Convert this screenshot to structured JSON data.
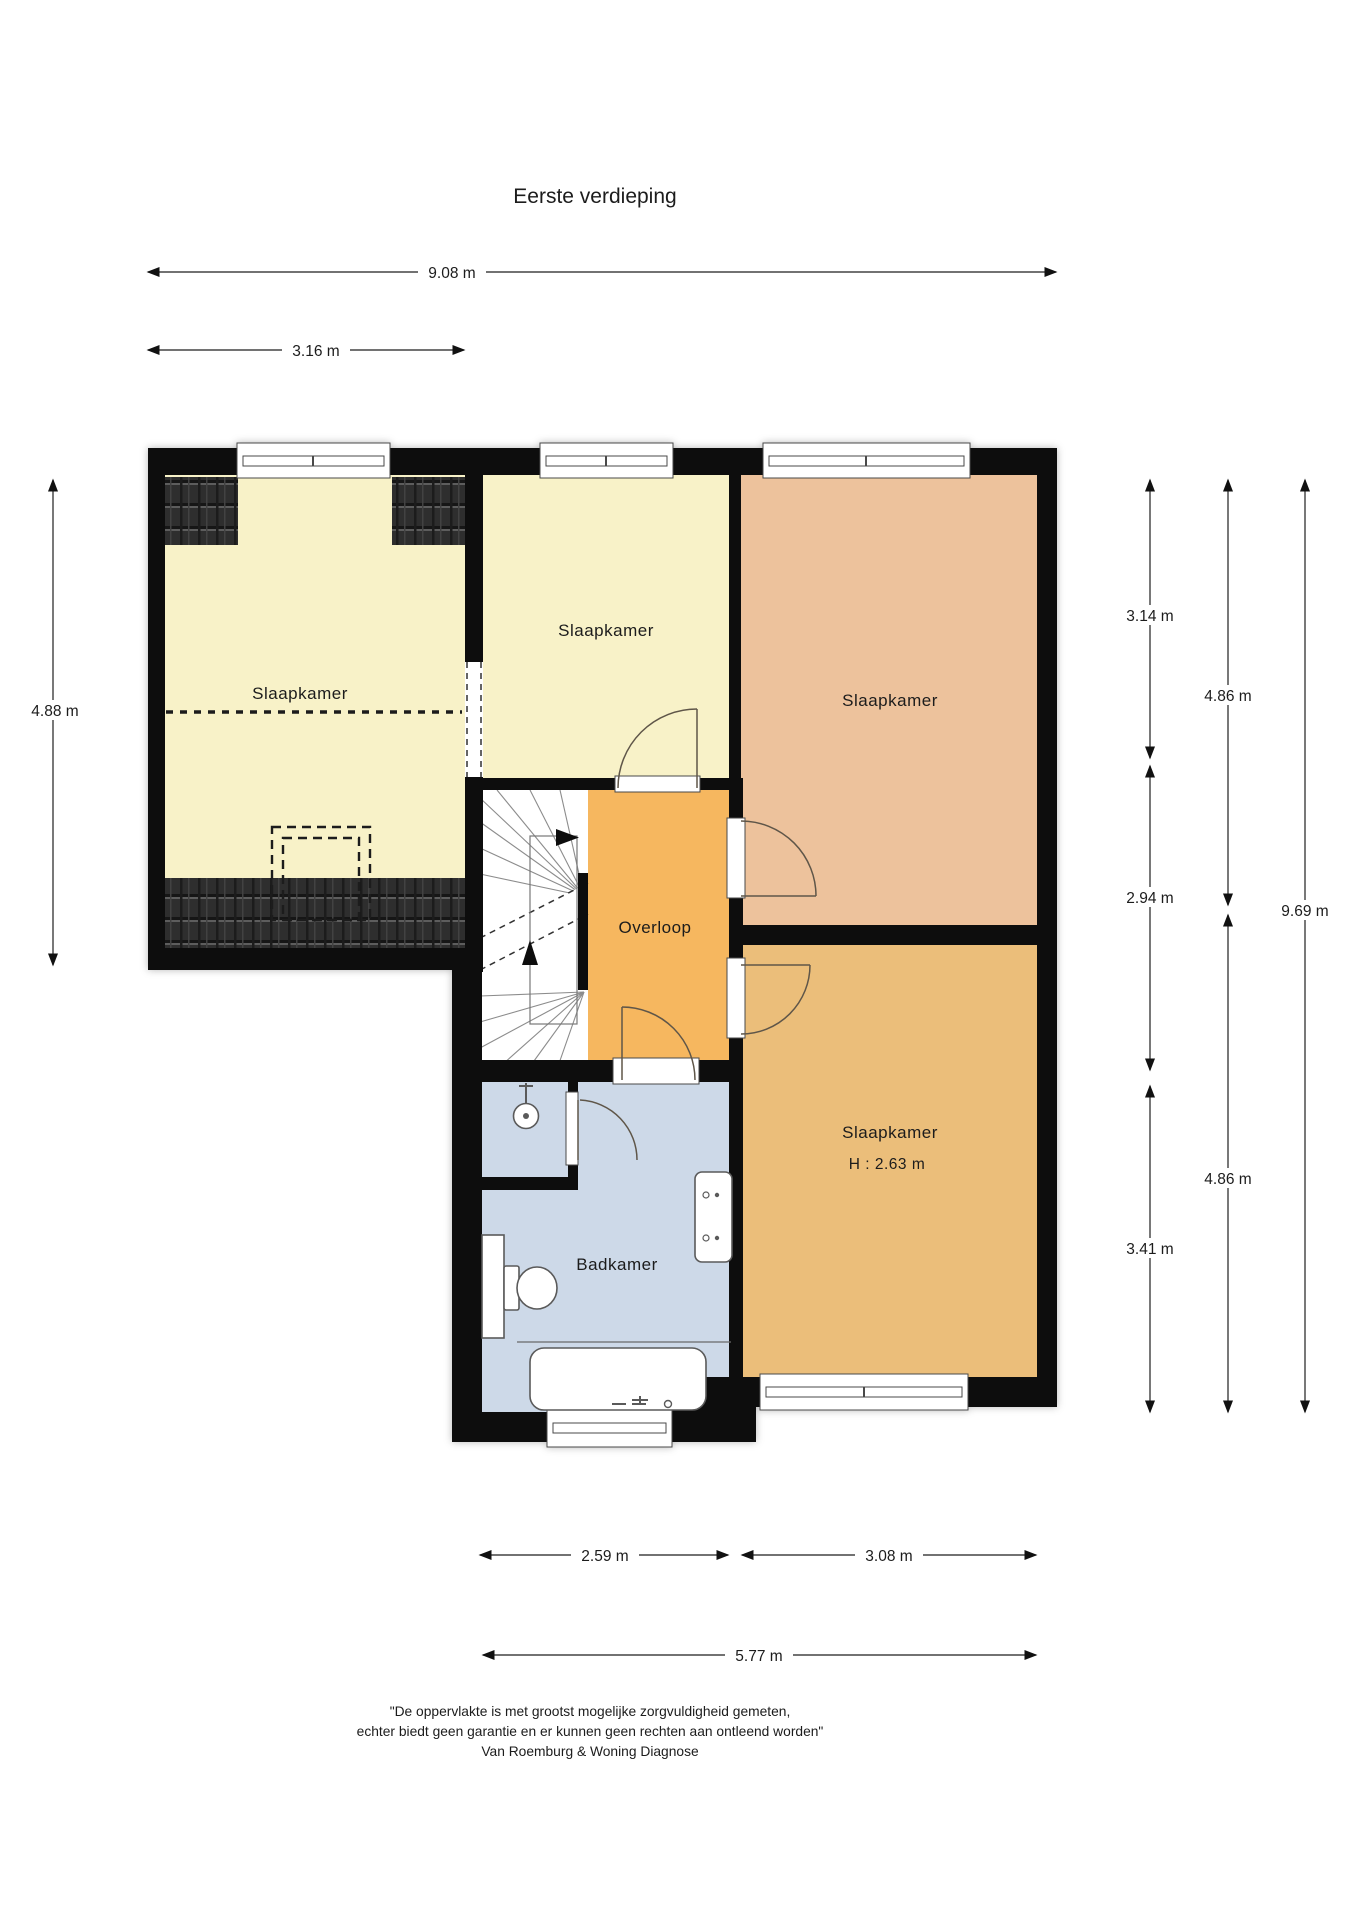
{
  "title": "Eerste verdieping",
  "colors": {
    "wall": "#0b0b0b",
    "bedroom_yellow": "#f8f2c8",
    "bedroom_salmon": "#edc29c",
    "bedroom_gold": "#ebbe7a",
    "overloop_orange": "#f6b75f",
    "bathroom_blue": "#cdd9e8",
    "roof_dark": "#2f2f2f"
  },
  "rooms": {
    "bedroom_left": {
      "label": "Slaapkamer"
    },
    "bedroom_mid": {
      "label": "Slaapkamer"
    },
    "bedroom_right": {
      "label": "Slaapkamer"
    },
    "bedroom_bottom": {
      "label": "Slaapkamer",
      "height_note": "H : 2.63 m"
    },
    "overloop": {
      "label": "Overloop"
    },
    "bathroom": {
      "label": "Badkamer"
    }
  },
  "dimensions": {
    "top_total": "9.08 m",
    "top_left": "3.16 m",
    "left_height": "4.88 m",
    "right_inner_top": "3.14 m",
    "right_inner_mid": "2.94 m",
    "right_inner_bottom": "3.41 m",
    "right_outer_top": "4.86 m",
    "right_outer_bottom": "4.86 m",
    "right_total": "9.69 m",
    "bottom_left": "2.59 m",
    "bottom_right": "3.08 m",
    "bottom_total": "5.77 m"
  },
  "footer": {
    "line1": "\"De oppervlakte is met grootst mogelijke zorgvuldigheid gemeten,",
    "line2": "echter biedt geen garantie en er kunnen geen rechten aan ontleend worden\"",
    "line3": "Van Roemburg & Woning Diagnose"
  }
}
